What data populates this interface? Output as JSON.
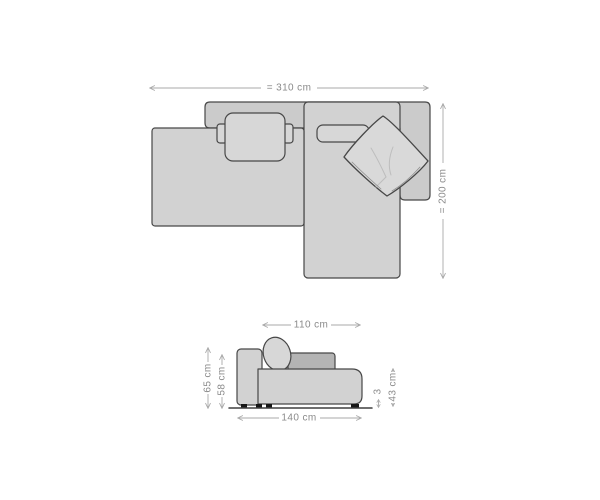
{
  "diagram": {
    "type": "sofa-dimension-drawing",
    "top_view": {
      "width_label": "= 310 cm",
      "depth_label": "= 200 cm"
    },
    "side_view": {
      "seat_depth_label": "110 cm",
      "total_depth_label": "140 cm",
      "total_height_label": "65 cm",
      "backrest_height_label": "58 cm",
      "seat_height_label": "43 cm",
      "feet_height_label": "3"
    },
    "colors": {
      "background": "#ffffff",
      "sofa_fill": "#d2d2d2",
      "sofa_fill_dark": "#b4b4b4",
      "outline": "#474747",
      "dimension_line": "#a8a8a8",
      "dimension_text": "#8a8a8a",
      "feet": "#161616"
    }
  }
}
